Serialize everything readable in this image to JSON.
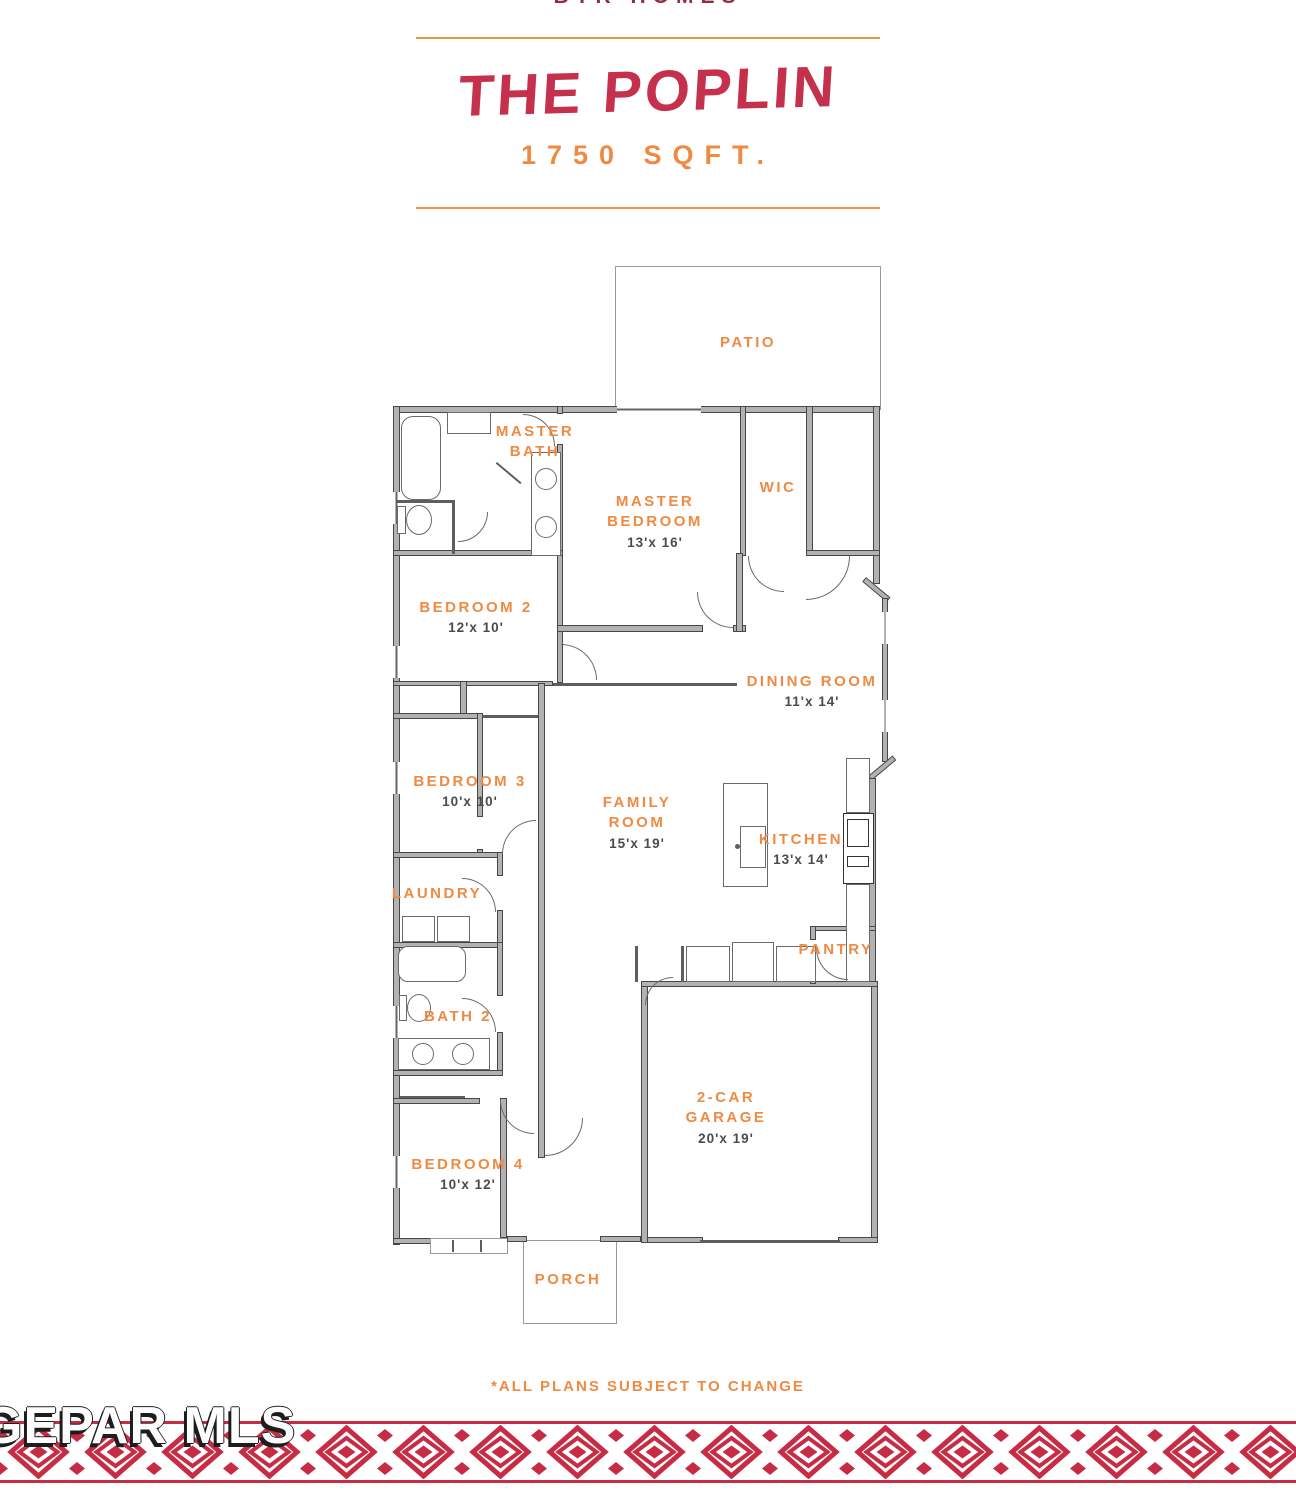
{
  "header": {
    "brand": "BTR HOMES",
    "title": "THE POPLIN",
    "sqft": "1750 SQFT."
  },
  "rooms": {
    "patio": {
      "name": "PATIO",
      "dims": ""
    },
    "master_bath": {
      "name": "MASTER BATH",
      "dims": ""
    },
    "master_bedroom": {
      "name": "MASTER BEDROOM",
      "dims": "13'x 16'"
    },
    "wic": {
      "name": "WIC",
      "dims": ""
    },
    "bedroom2": {
      "name": "BEDROOM 2",
      "dims": "12'x 10'"
    },
    "dining": {
      "name": "DINING ROOM",
      "dims": "11'x 14'"
    },
    "bedroom3": {
      "name": "BEDROOM 3",
      "dims": "10'x 10'"
    },
    "family": {
      "name": "FAMILY ROOM",
      "dims": "15'x 19'"
    },
    "kitchen": {
      "name": "KITCHEN",
      "dims": "13'x 14'"
    },
    "laundry": {
      "name": "LAUNDRY",
      "dims": ""
    },
    "pantry": {
      "name": "PANTRY",
      "dims": ""
    },
    "bath2": {
      "name": "BATH 2",
      "dims": ""
    },
    "garage": {
      "name": "2-CAR GARAGE",
      "dims": "20'x 19'"
    },
    "bedroom4": {
      "name": "BEDROOM 4",
      "dims": "10'x 12'"
    },
    "porch": {
      "name": "PORCH",
      "dims": ""
    }
  },
  "footer": {
    "disclaimer": "*ALL PLANS SUBJECT TO CHANGE",
    "watermark": "GEPAR MLS"
  },
  "colors": {
    "accent_red": "#C5304C",
    "accent_orange": "#EE8A42",
    "dimension_gray": "#4B4B4D",
    "wall_gray": "#B2B2B2",
    "pattern_red": "#C62D45"
  }
}
